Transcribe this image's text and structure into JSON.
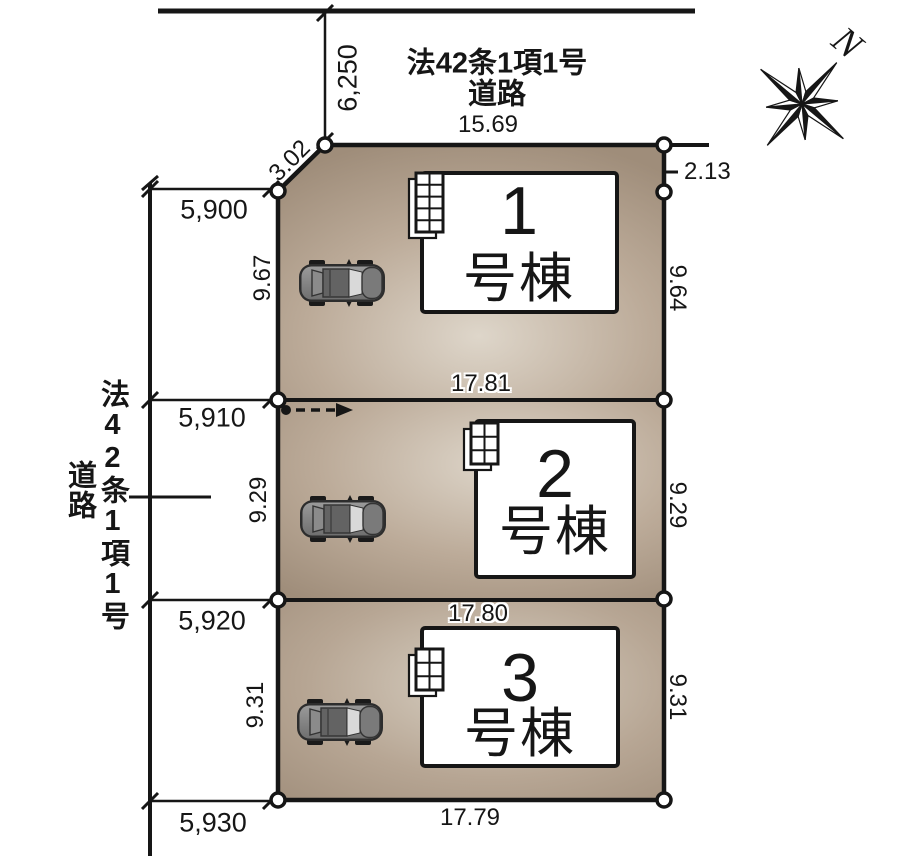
{
  "plan": {
    "top_road": {
      "label_line1": "法42条1項1号",
      "label_line2": "道路",
      "road_width_dim": "6,250",
      "frontage_dim": "15.69"
    },
    "left_road": {
      "label_line1": "法42条1項1号",
      "label_line2": "道路"
    },
    "compass": {
      "north": "N"
    },
    "site": {
      "corner_cut_dim": "3.02",
      "right_setback_dim": "2.13",
      "bottom_width_dim": "17.79",
      "frontage_dims": [
        "5,900",
        "5,910",
        "5,920",
        "5,930"
      ]
    },
    "lots": [
      {
        "number": "1",
        "suffix": "号棟",
        "depth_left": "9.67",
        "depth_right": "9.64",
        "boundary_width": "17.81"
      },
      {
        "number": "2",
        "suffix": "号棟",
        "depth_left": "9.29",
        "depth_right": "9.29",
        "boundary_width": "17.80"
      },
      {
        "number": "3",
        "suffix": "号棟",
        "depth_left": "9.31",
        "depth_right": "9.31"
      }
    ],
    "colors": {
      "parcel_dark": "#a08e7b",
      "parcel_light": "#ded6ca",
      "line": "#161616",
      "building_fill": "#ffffff"
    }
  }
}
